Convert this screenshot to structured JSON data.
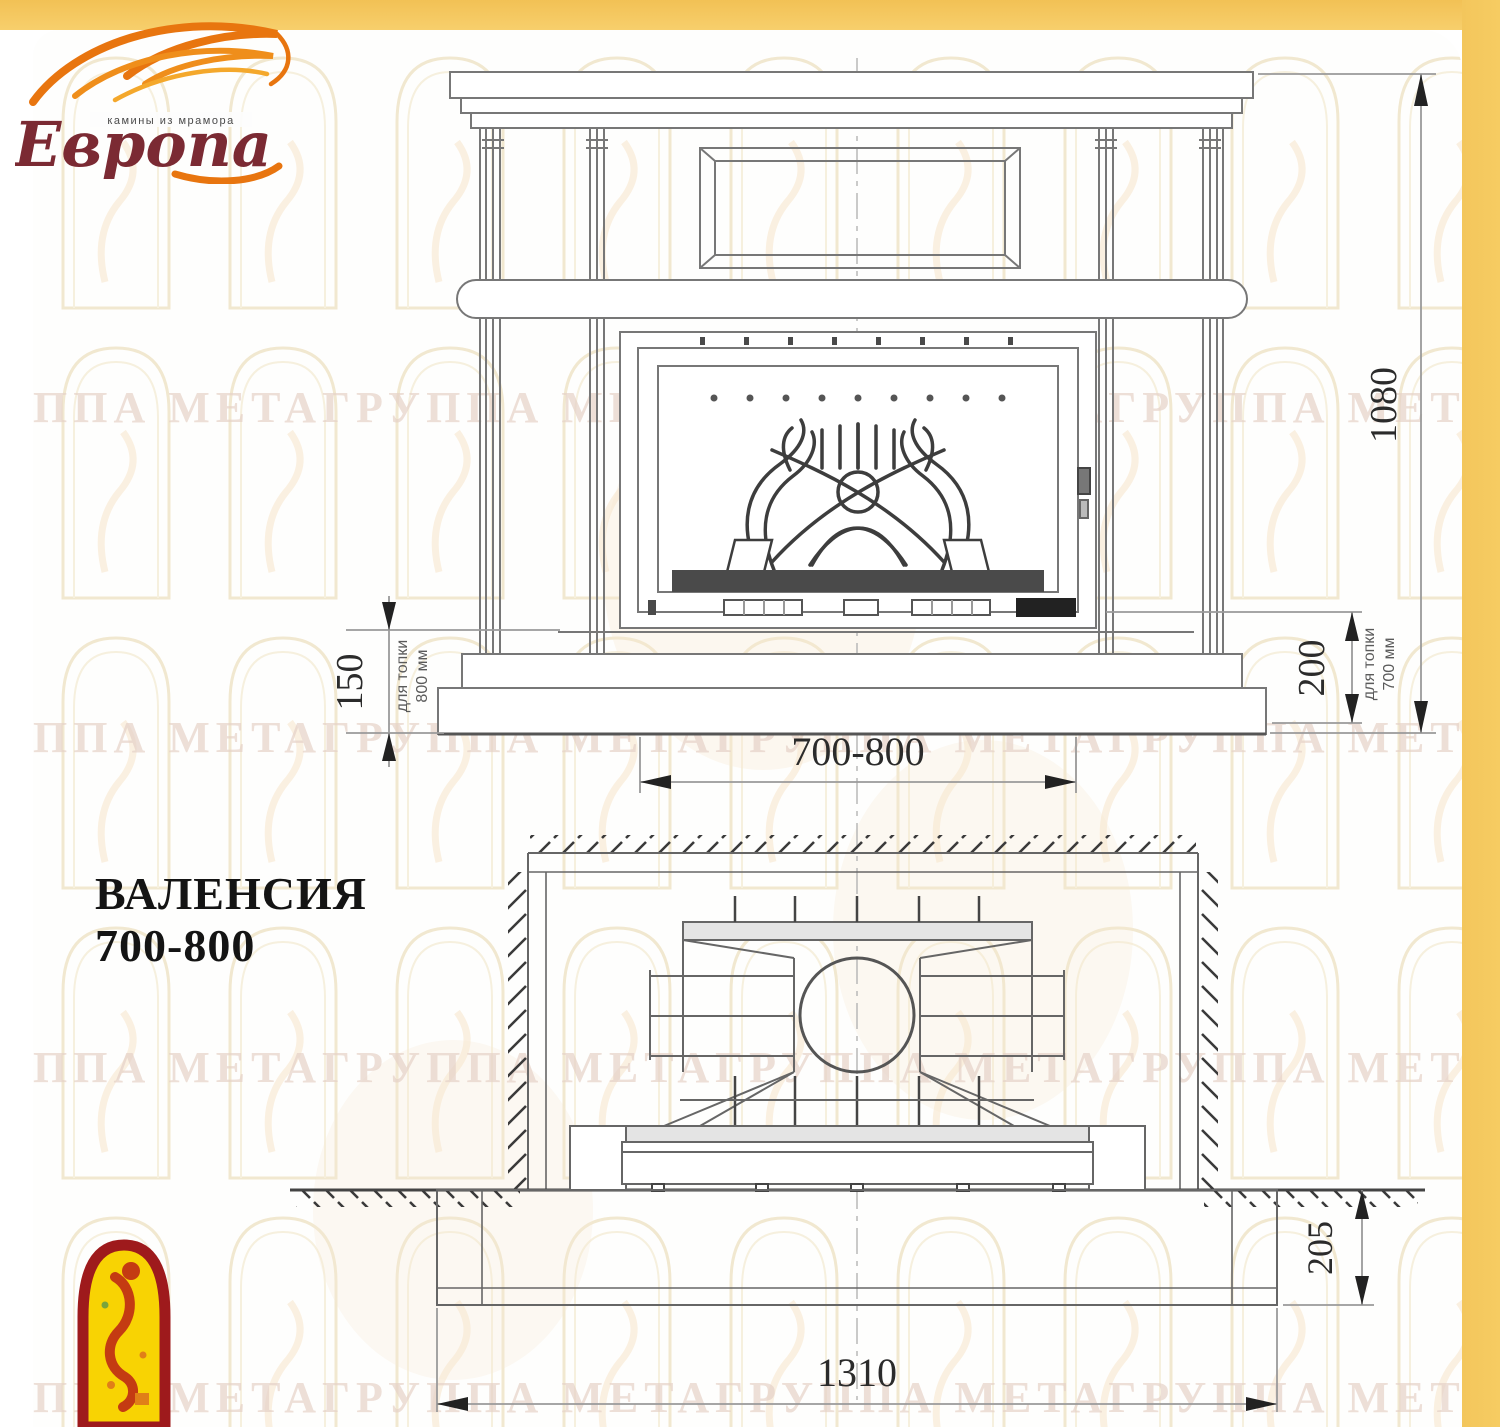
{
  "branding": {
    "logo_text": "Европа",
    "logo_tagline": "камины из мрамора"
  },
  "title": {
    "line1": "ВАЛЕНСИЯ",
    "line2": "700-800"
  },
  "front_view": {
    "dim_total_height": "1080",
    "dim_hearth_height_left": "150",
    "note_left_line1": "для топки",
    "note_left_line2": "800 мм",
    "dim_hearth_height_right": "200",
    "note_right_line1": "для топки",
    "note_right_line2": "700 мм",
    "dim_firebox_width": "700-800"
  },
  "plan_view": {
    "dim_platform_depth": "205",
    "dim_platform_width": "1310"
  },
  "watermark": {
    "text": "ППА МЕТАГРУППА МЕТАГРУППА МЕТАГРУППА МЕТАГРУППА МЕТАГРУППА МЕТАГРУППА МЕТА"
  },
  "colors": {
    "frame": "#F5C95C",
    "flame": "#E8750F",
    "logo_text": "#7B2A33",
    "emblem_border": "#9E1A1C",
    "emblem_fill": "#F8D303"
  }
}
